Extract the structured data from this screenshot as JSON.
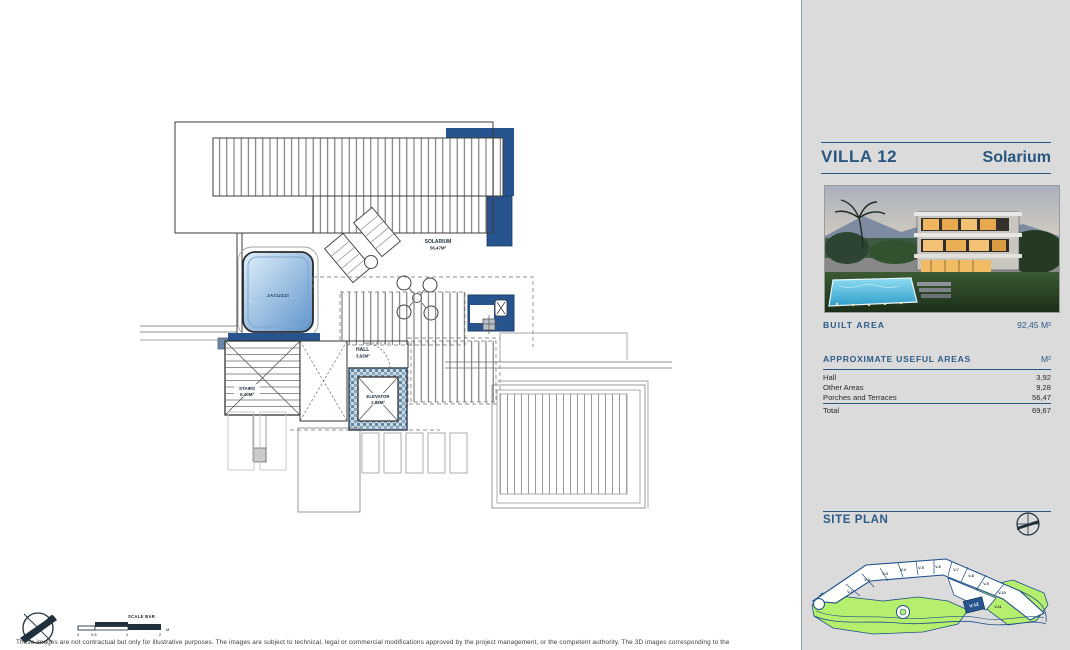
{
  "sidebar": {
    "villa_title": "VILLA 12",
    "plan_title": "Solarium",
    "built_area_label": "BUILT AREA",
    "built_area_value": "92,45 M²",
    "useful_areas_label": "APPROXIMATE USEFUL AREAS",
    "useful_areas_unit": "M²",
    "rows": [
      {
        "label": "Hall",
        "value": "3,92"
      },
      {
        "label": "Other Areas",
        "value": "9,28"
      },
      {
        "label": "Porches and Terraces",
        "value": "56,47"
      }
    ],
    "total_label": "Total",
    "total_value": "69,67",
    "site_plan_label": "SITE PLAN"
  },
  "plan": {
    "solarium_label": "SOLARIUM",
    "solarium_value": "56,47M²",
    "jacuzzi_label": "JACUZZI",
    "hall_label": "HALL",
    "hall_value": "3,92M²",
    "stairs_label": "STAIRS",
    "stairs_value": "6,40M²",
    "elevator_label": "ELEVATOR",
    "elevator_value": "2,88M²"
  },
  "site_plan": {
    "plots": [
      "V-1",
      "V-2",
      "V-3",
      "V-4",
      "V-5",
      "V-6",
      "V-7",
      "V-8",
      "V-9",
      "V-10",
      "V-11"
    ],
    "highlighted_plot": "V-12"
  },
  "scale_bar": {
    "label": "SCALE BAR",
    "ticks": [
      "0",
      "0,5",
      "1",
      "2"
    ],
    "unit": "M"
  },
  "footer": {
    "disclaimer": "These images are not contractual but only for illustrative purposes. The images are subject to technical, legal or commercial modifications approved by the project management, or the competent authority. The 3D images corresponding to the"
  },
  "colors": {
    "navy": "#29567f",
    "plan_blue": "#27548e",
    "site_green": "#b6ee6e"
  }
}
